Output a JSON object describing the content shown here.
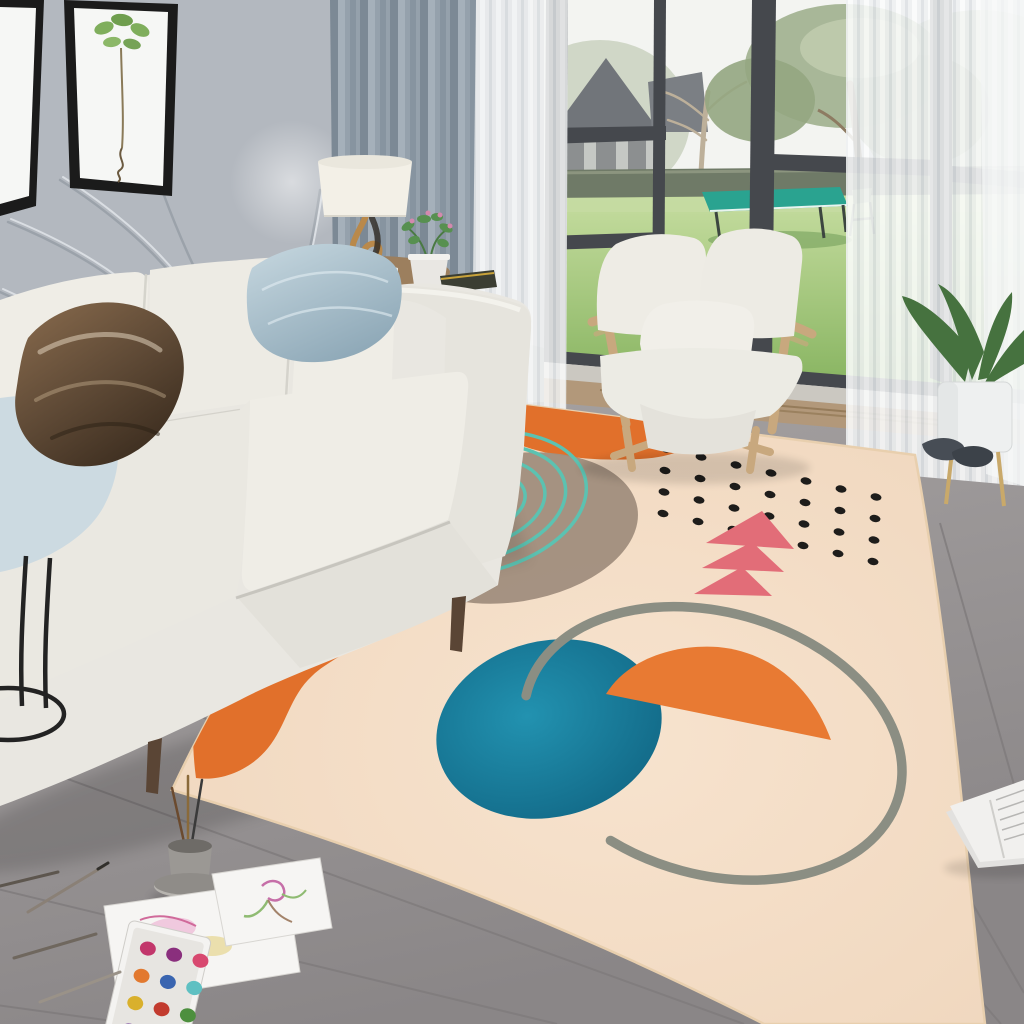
{
  "meta": {
    "title": "Living room photograph: white sofa, garden window, and abstract cream area rug with orange blobs, taupe circle, teal rings, black dot grid, pink triangles, teal circle, orange half-moon and gray open arc",
    "image_type": "photograph",
    "visible_text": "none"
  },
  "colors": {
    "wall": "#b3b8bf",
    "wall-decal": "#99a0a8",
    "frame": "#1b1b1b",
    "frame-mat": "#f6f7f5",
    "art-leaf": "#7fae5c",
    "curtain": "#8d99a5",
    "sheer": "#eef0f2",
    "window-frame": "#45484d",
    "sky": "#f3f4f1",
    "foliage": "#a3b392",
    "lawn": "#9ac473",
    "garden-wall": "#6f7a67",
    "tt-table": "#2aa390",
    "house-roof": "#71757a",
    "house-wall": "#c5c8c4",
    "armchair-wood": "#c8a87e",
    "cushion-white": "#edebe4",
    "sofa": "#e9e7e1",
    "sofa-shade": "#d2d0c9",
    "pillow-blue": "#a9c0cc",
    "pillow-brown": "#5f4a36",
    "pillow-lightblue": "#ccdae1",
    "lamp-shade": "#f3f0e7",
    "lamp-gold": "#b9894b",
    "table-wood": "#9c7f5e",
    "floor": "#9a9697",
    "plank-line": "#7f7b7c",
    "stone": "#cbc8c1",
    "marble": "#b2987a",
    "marble-vein": "#7e653f",
    "rug-base": "#f4ddc7",
    "rug-orange": "#e1702b",
    "rug-orange2": "#e87a33",
    "rug-taupe": "#a28f7f",
    "rug-teal-ring": "#5cc2b1",
    "rug-blue": "#157e9d",
    "rug-pink": "#e26d78",
    "rug-dot": "#1e1d1b",
    "rug-arc": "#8b8e83",
    "paper": "#f6f5f3",
    "plant-green": "#46723f",
    "pot-white": "#eef0f0",
    "slipper": "#474d55",
    "book-page": "#f1f0ee"
  },
  "scene": {
    "left_wall": {
      "decor": "leaf line mural",
      "frames": [
        {
          "content": "white matted frame, partially cropped"
        },
        {
          "content": "botanical print, green leaves with hanging root"
        }
      ]
    },
    "window": {
      "garden_items": [
        "lawn",
        "garden wall",
        "bare tree",
        "large tree",
        "gabled house",
        "table tennis table",
        "folding chair"
      ]
    },
    "curtains": {
      "left": "gray blackout curtain",
      "inner": "white sheer",
      "right": "white sheer"
    },
    "furniture": {
      "sofa": "white three-seat fabric sofa",
      "pillows": [
        "metallic bronze satin",
        "blue-gray satin",
        "light blue"
      ],
      "armchair": "light wood frame lounge chair with white cushions",
      "side_table": "round wood side table",
      "lamp": "white drum shade lamp with gold sculptural base",
      "c_table": "black metal ring side table"
    },
    "rug": {
      "style": "abstract shapes on cream ground",
      "shapes": [
        {
          "name": "orange-blob-top"
        },
        {
          "name": "orange-blob-left"
        },
        {
          "name": "taupe-circle"
        },
        {
          "name": "teal-concentric-rings",
          "count": 4
        },
        {
          "name": "black-dot-grid"
        },
        {
          "name": "pink-triangles",
          "count": 3
        },
        {
          "name": "teal-circle"
        },
        {
          "name": "orange-half-moon"
        },
        {
          "name": "gray-open-arc"
        }
      ],
      "dot_grid": {
        "rows": 4,
        "cols": 7,
        "origin": [
          666,
          449
        ],
        "col_step": [
          35,
          8
        ],
        "row_step": [
          -1,
          21.5
        ],
        "dot_rx": 5.5,
        "dot_ry": 3.6,
        "angle": 12
      }
    },
    "floor": {
      "material": "gray wood planks laid diagonally"
    },
    "floor_items": {
      "watercolor_paintings": 2,
      "paint_palette": {
        "colors": [
          "#c2366b",
          "#8a2f7d",
          "#d8486f",
          "#e2792f",
          "#3a65b0",
          "#5fc0c2",
          "#d9b02c",
          "#c23b2e",
          "#4d8f3e",
          "#7a4a9e",
          "#2b4d9b",
          "#e07aa8"
        ],
        "origin": [
          142,
          952
        ],
        "step": [
          27,
          28
        ],
        "rx": 8,
        "ry": 7
      },
      "brush_cup": true,
      "pencils": 4,
      "magazine": "open magazine, bottom right corner"
    },
    "plant": {
      "type": "potted plant",
      "pot": "white planter with gold legs"
    },
    "slippers": 2
  }
}
